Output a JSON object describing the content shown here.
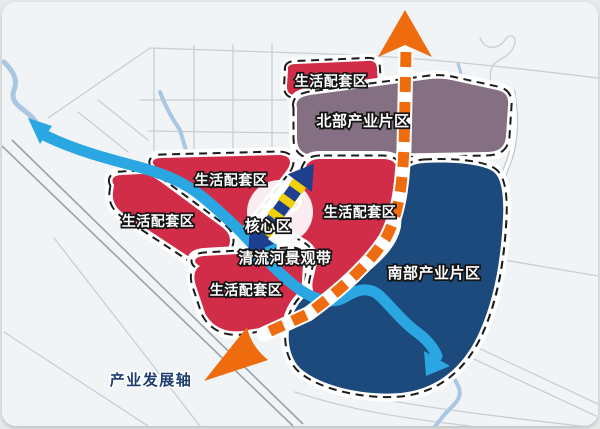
{
  "map": {
    "zones": [
      {
        "id": "north-strip",
        "label": "生活配套区",
        "color": "#d22d48"
      },
      {
        "id": "north-industrial",
        "label": "北部产业片区",
        "color": "#847082"
      },
      {
        "id": "living-upper",
        "label": "生活配套区",
        "color": "#d22d48"
      },
      {
        "id": "living-right",
        "label": "生活配套区",
        "color": "#d22d48"
      },
      {
        "id": "living-left",
        "label": "生活配套区",
        "color": "#d22d48"
      },
      {
        "id": "living-bottom",
        "label": "生活配套区",
        "color": "#d22d48"
      },
      {
        "id": "south-industrial",
        "label": "南部产业片区",
        "color": "#1c4a7c"
      }
    ],
    "annotations": {
      "core": "核心区",
      "river_belt": "清流河景观带",
      "axis": "产业发展轴"
    },
    "colors": {
      "living_red": "#d22d48",
      "north_purple": "#847082",
      "south_navy": "#1c4a7c",
      "axis_orange": "#ee6b0e",
      "river": "#2aa7e2",
      "river_pale": "#a9c7e3",
      "core_arrow_blue": "#1e3e8f",
      "core_stripe_yellow": "#f2cf08",
      "axis_text": "#1d3c70",
      "zone_border": "#1b1b1b",
      "road": "#c9ced3",
      "railway": "#9aa2a8",
      "map_bg": "#f0f4f6"
    }
  }
}
